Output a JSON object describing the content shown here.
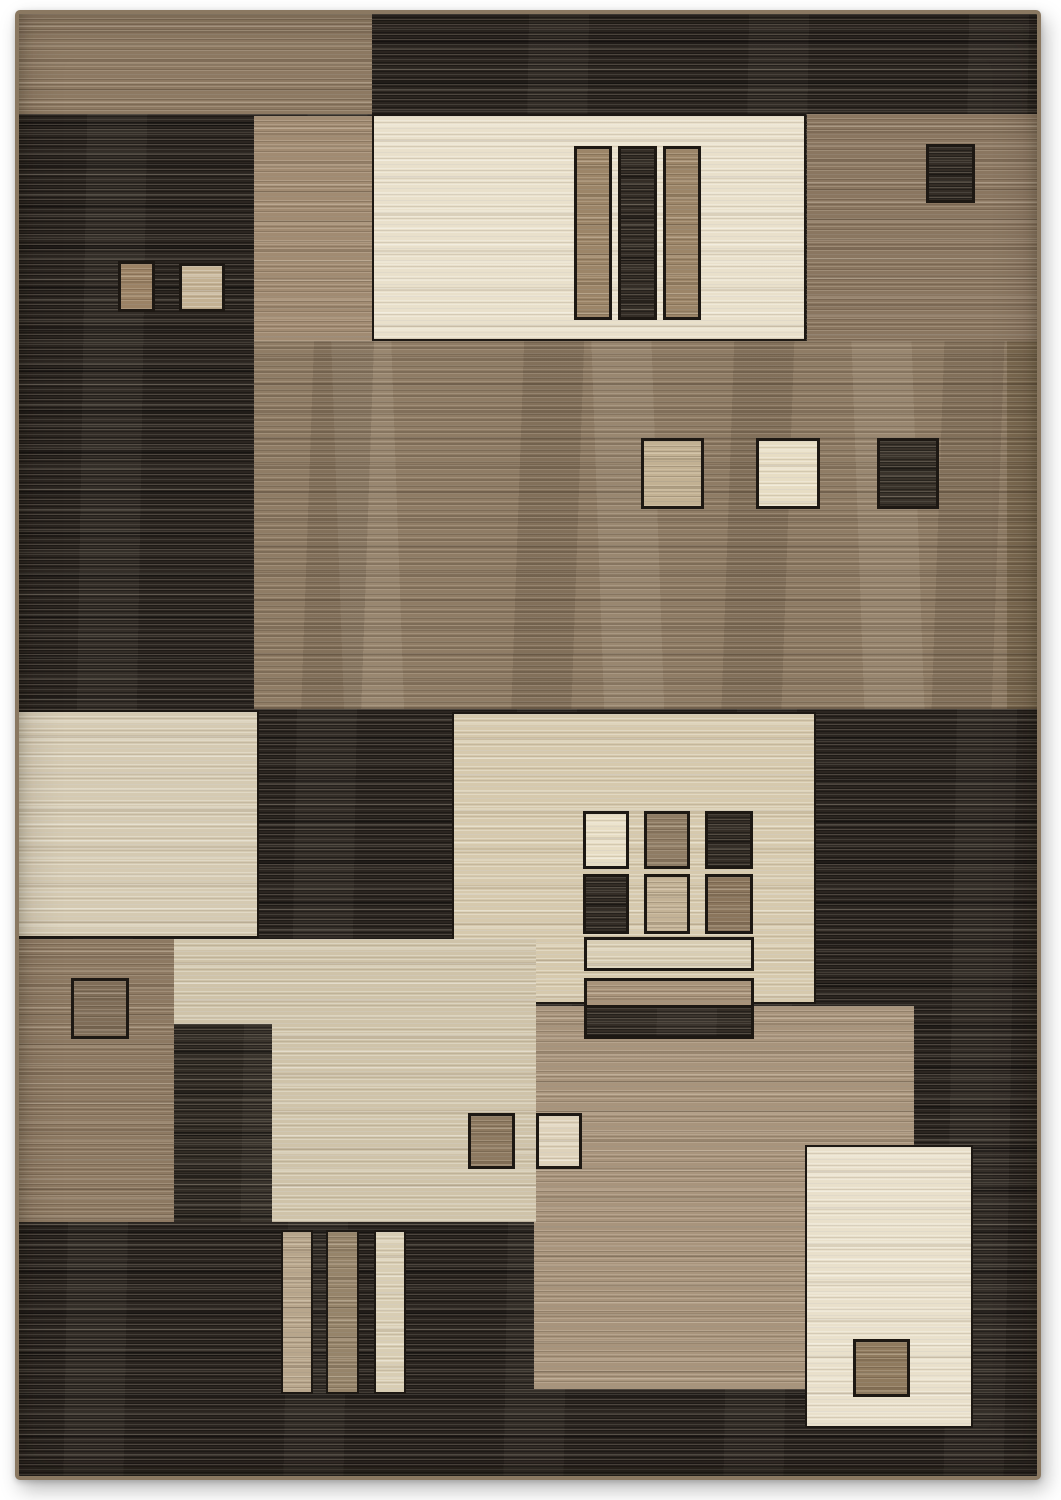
{
  "image": {
    "alt": "Product photo of a modern abstract geometric area rug with overlapping rectangles in charcoal, brown, taupe, beige and cream, each block woven with horizontal striations and small contrasting squares",
    "background": "#ffffff"
  },
  "rug": {
    "x": 15,
    "y": 10,
    "width": 1026,
    "height": 1470,
    "base_tone": "dark_base",
    "palette": {
      "dark_base": "#2b2520",
      "dark_sq": "#342d26",
      "dark_sq2": "#3a332b",
      "dark_strip": "#322c25",
      "tan": "#8d7962",
      "taupe_light": "#a18b72",
      "taupe": "#8a7660",
      "taupe_band": "#8f7c65",
      "taupe_dark": "#7a684f",
      "taupe_mid": "#a8947c",
      "cream": "#e9e0cb",
      "cream_bright": "#d5cab2",
      "beige": "#d6c9ad",
      "beige2": "#cfc3a9",
      "tan_bar": "#9c8568",
      "tan_bar2": "#b8a68c",
      "tan_bar3": "#a8937a",
      "brown_bar": "#96846a",
      "cream_bar": "#d8cdb3",
      "light_tan2": "#c2b193",
      "cream_sq": "#e7ddc4",
      "tan_sq2": "#8f7c64",
      "light_tan": "#c3b296",
      "brown_sq": "#8a755c",
      "brown": "#8f7a5e",
      "brown_pair": "#8d7960",
      "cream_pair": "#ded2ba",
      "tan_small": "#9b8265",
      "beige_sq": "#c3b193",
      "tan_dark_sq": "#7f6d58",
      "binding": "#8a7861",
      "outline": "#1d1813"
    },
    "blocks": [
      {
        "name": "top-tan-band",
        "x": 0,
        "y": 0,
        "w": 353,
        "h": 100,
        "tone": "tan",
        "tex": "mid",
        "outline": 0
      },
      {
        "name": "upper-taupe-strip",
        "x": 235,
        "y": 102,
        "w": 118,
        "h": 225,
        "tone": "taupe_light",
        "tex": "mid",
        "outline": 0
      },
      {
        "name": "upper-cream-panel",
        "x": 355,
        "y": 102,
        "w": 430,
        "h": 223,
        "tone": "cream",
        "tex": "light",
        "outline": 2
      },
      {
        "name": "upper-right-taupe-panel",
        "x": 788,
        "y": 100,
        "w": 238,
        "h": 237,
        "tone": "taupe",
        "tex": "mid",
        "outline": 0
      },
      {
        "name": "middle-taupe-band",
        "x": 235,
        "y": 327,
        "w": 791,
        "h": 368,
        "tone": "taupe_band",
        "tex": "band",
        "outline": 0
      },
      {
        "name": "middle-band-right-shade",
        "x": 988,
        "y": 327,
        "w": 38,
        "h": 368,
        "tone": "taupe_dark",
        "tex": "band",
        "outline": 0
      },
      {
        "name": "left-cream-panel",
        "x": 0,
        "y": 698,
        "w": 238,
        "h": 224,
        "tone": "cream_bright",
        "tex": "light",
        "outline": 2
      },
      {
        "name": "center-beige-panel",
        "x": 435,
        "y": 700,
        "w": 360,
        "h": 288,
        "tone": "beige",
        "tex": "light",
        "outline": 2
      },
      {
        "name": "bottom-taupe-panel",
        "x": 515,
        "y": 992,
        "w": 380,
        "h": 383,
        "tone": "taupe_mid",
        "tex": "mid",
        "outline": 0
      },
      {
        "name": "left-tan-panel",
        "x": 0,
        "y": 925,
        "w": 155,
        "h": 283,
        "tone": "tan",
        "tex": "mid",
        "outline": 0
      },
      {
        "name": "lower-beige-panel",
        "x": 155,
        "y": 925,
        "w": 362,
        "h": 283,
        "tone": "beige2",
        "tex": "light",
        "outline": 0
      },
      {
        "name": "lower-dark-strip",
        "x": 155,
        "y": 1010,
        "w": 98,
        "h": 198,
        "tone": "dark_strip",
        "tex": "dark",
        "outline": 0
      },
      {
        "name": "bottom-right-cream-panel",
        "x": 788,
        "y": 1133,
        "w": 164,
        "h": 279,
        "tone": "cream",
        "tex": "light",
        "outline": 2
      },
      {
        "name": "upper-bar-tan-left",
        "x": 558,
        "y": 135,
        "w": 32,
        "h": 168,
        "tone": "tan_bar",
        "tex": "mid",
        "outline": 3
      },
      {
        "name": "upper-bar-dark",
        "x": 602,
        "y": 135,
        "w": 33,
        "h": 168,
        "tone": "dark_sq",
        "tex": "dark",
        "outline": 3
      },
      {
        "name": "upper-bar-tan-right",
        "x": 647,
        "y": 135,
        "w": 32,
        "h": 168,
        "tone": "tan_bar",
        "tex": "mid",
        "outline": 3
      },
      {
        "name": "upper-right-dark-square",
        "x": 910,
        "y": 133,
        "w": 43,
        "h": 53,
        "tone": "dark_sq",
        "tex": "dark",
        "outline": 3
      },
      {
        "name": "upper-left-square-tan",
        "x": 102,
        "y": 250,
        "w": 31,
        "h": 45,
        "tone": "tan_small",
        "tex": "mid",
        "outline": 3
      },
      {
        "name": "upper-left-square-beige",
        "x": 163,
        "y": 252,
        "w": 40,
        "h": 43,
        "tone": "beige_sq",
        "tex": "light",
        "outline": 3
      },
      {
        "name": "middle-square-tan",
        "x": 625,
        "y": 427,
        "w": 57,
        "h": 65,
        "tone": "light_tan2",
        "tex": "mid",
        "outline": 3
      },
      {
        "name": "middle-square-cream",
        "x": 740,
        "y": 427,
        "w": 58,
        "h": 65,
        "tone": "cream_sq",
        "tex": "light",
        "outline": 3
      },
      {
        "name": "middle-square-dark",
        "x": 861,
        "y": 427,
        "w": 56,
        "h": 65,
        "tone": "dark_sq2",
        "tex": "dark",
        "outline": 3
      },
      {
        "name": "grid-square-cream",
        "x": 567,
        "y": 800,
        "w": 40,
        "h": 52,
        "tone": "cream_sq",
        "tex": "light",
        "outline": 3
      },
      {
        "name": "grid-square-tan",
        "x": 628,
        "y": 800,
        "w": 40,
        "h": 52,
        "tone": "tan_sq2",
        "tex": "mid",
        "outline": 3
      },
      {
        "name": "grid-square-dark-1",
        "x": 689,
        "y": 800,
        "w": 42,
        "h": 52,
        "tone": "dark_sq",
        "tex": "dark",
        "outline": 3
      },
      {
        "name": "grid-square-dark-2",
        "x": 567,
        "y": 863,
        "w": 40,
        "h": 54,
        "tone": "dark_sq",
        "tex": "dark",
        "outline": 3
      },
      {
        "name": "grid-square-light-tan",
        "x": 628,
        "y": 863,
        "w": 40,
        "h": 54,
        "tone": "light_tan",
        "tex": "mid",
        "outline": 3
      },
      {
        "name": "grid-square-brown",
        "x": 689,
        "y": 863,
        "w": 42,
        "h": 54,
        "tone": "brown_sq",
        "tex": "mid",
        "outline": 3
      },
      {
        "name": "grid-bar-cream",
        "x": 568,
        "y": 926,
        "w": 164,
        "h": 28,
        "tone": "cream_bar",
        "tex": "light",
        "outline": 3
      },
      {
        "name": "grid-bar-tan",
        "x": 568,
        "y": 967,
        "w": 164,
        "h": 25,
        "tone": "tan_bar3",
        "tex": "mid",
        "outline": 3
      },
      {
        "name": "grid-bar-dark",
        "x": 568,
        "y": 994,
        "w": 164,
        "h": 28,
        "tone": "dark_sq",
        "tex": "dark",
        "outline": 3
      },
      {
        "name": "left-tan-square-outline",
        "x": 55,
        "y": 967,
        "w": 52,
        "h": 55,
        "tone": "tan_dark_sq",
        "tex": "mid",
        "outline": 3
      },
      {
        "name": "pair-square-brown",
        "x": 452,
        "y": 1102,
        "w": 41,
        "h": 50,
        "tone": "brown_pair",
        "tex": "mid",
        "outline": 3
      },
      {
        "name": "pair-square-cream",
        "x": 520,
        "y": 1102,
        "w": 40,
        "h": 50,
        "tone": "cream_pair",
        "tex": "light",
        "outline": 3
      },
      {
        "name": "bottom-bar-tan",
        "x": 264,
        "y": 1218,
        "w": 28,
        "h": 160,
        "tone": "tan_bar2",
        "tex": "mid",
        "outline": 2
      },
      {
        "name": "bottom-bar-brown",
        "x": 309,
        "y": 1218,
        "w": 29,
        "h": 160,
        "tone": "brown_bar",
        "tex": "mid",
        "outline": 2
      },
      {
        "name": "bottom-bar-cream",
        "x": 357,
        "y": 1218,
        "w": 28,
        "h": 160,
        "tone": "cream_bar",
        "tex": "light",
        "outline": 2
      },
      {
        "name": "bottom-right-brown-square",
        "x": 837,
        "y": 1328,
        "w": 51,
        "h": 52,
        "tone": "brown",
        "tex": "mid",
        "outline": 3
      }
    ]
  }
}
